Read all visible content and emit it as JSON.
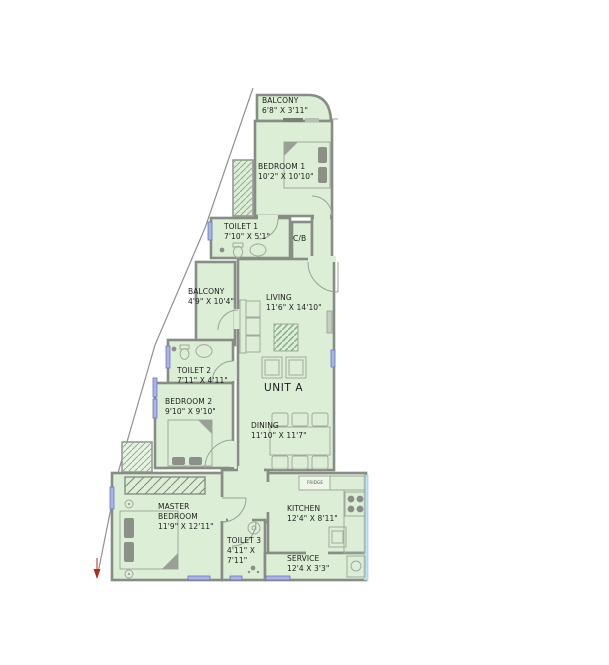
{
  "plan": {
    "unit_label": "UNIT A",
    "rooms": [
      {
        "id": "balcony-top",
        "name": "BALCONY",
        "dims": "6'8\" X 3'11\""
      },
      {
        "id": "bedroom-1",
        "name": "BEDROOM 1",
        "dims": "10'2\" X 10'10\""
      },
      {
        "id": "toilet-1",
        "name": "TOILET 1",
        "dims": "7'10\" X 5'1\""
      },
      {
        "id": "cb-closet",
        "name": "C/B",
        "dims": ""
      },
      {
        "id": "balcony-side",
        "name": "BALCONY",
        "dims": "4'9\" X 10'4\""
      },
      {
        "id": "living",
        "name": "LIVING",
        "dims": "11'6\" X 14'10\""
      },
      {
        "id": "toilet-2",
        "name": "TOILET 2",
        "dims": "7'11\" X 4'11\""
      },
      {
        "id": "bedroom-2",
        "name": "BEDROOM 2",
        "dims": "9'10\" X 9'10\""
      },
      {
        "id": "dining",
        "name": "DINING",
        "dims": "11'10\" X 11'7\""
      },
      {
        "id": "master-bedroom",
        "name": "MASTER BEDROOM",
        "dims": "11'9\" X 12'11\""
      },
      {
        "id": "toilet-3",
        "name": "TOILET 3",
        "dims": "4'11\" X 7'11\""
      },
      {
        "id": "kitchen",
        "name": "KITCHEN",
        "dims": "12'4\" X 8'11\""
      },
      {
        "id": "service",
        "name": "SERVICE",
        "dims": "12'4 X 3'3\""
      }
    ],
    "labels": {
      "fridge": "FRIDGE"
    },
    "colors": {
      "room_fill": "#dcefd6",
      "wall_gray": "#878d85",
      "window_blue": "#7e88cf",
      "glазing_cyan": "#bfe4ec",
      "marker_red": "#b52a22"
    }
  }
}
